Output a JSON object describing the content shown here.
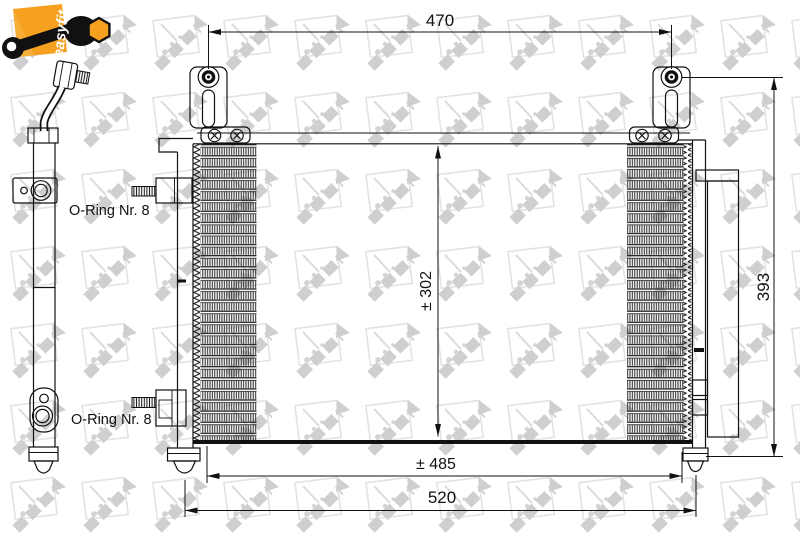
{
  "brand": {
    "badge_text": "easyfit"
  },
  "drawing": {
    "dim_top_width": "470",
    "dim_overall_height": "393",
    "dim_core_height": "± 302",
    "dim_mid_width": "± 485",
    "dim_overall_width": "520",
    "oring_label_top": "O-Ring Nr. 8",
    "oring_label_bottom": "O-Ring Nr. 8"
  },
  "colors": {
    "accent_orange": "#F6A01F",
    "line_black": "#111111",
    "watermark_gray": "#d9d9d9",
    "canvas_white": "#ffffff"
  }
}
